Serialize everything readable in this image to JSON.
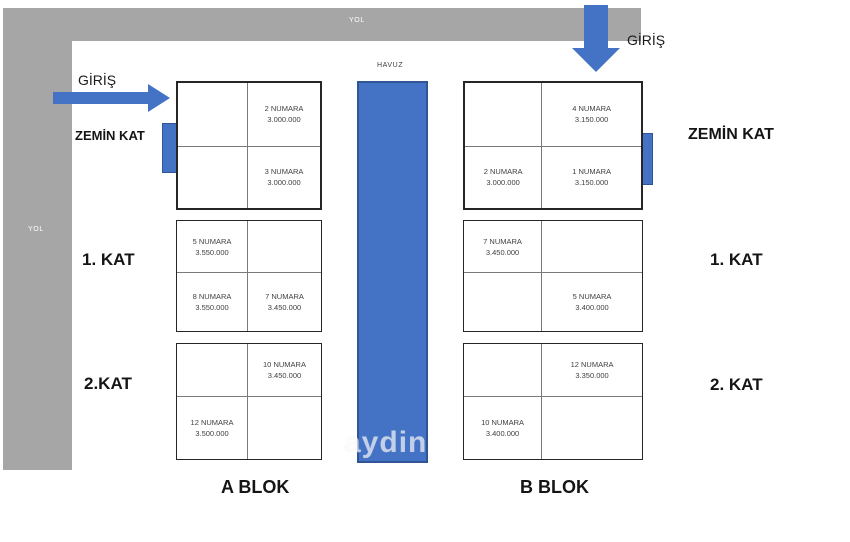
{
  "roads": {
    "top_label": "YOL",
    "left_label": "YOL"
  },
  "pool": {
    "label": "HAVUZ"
  },
  "entrances": {
    "left": "GİRİŞ",
    "right": "GİRİŞ"
  },
  "floor_labels": {
    "left": {
      "ground": "ZEMİN KAT",
      "first": "1. KAT",
      "second": "2.KAT"
    },
    "right": {
      "ground": "ZEMİN KAT",
      "first": "1. KAT",
      "second": "2. KAT"
    }
  },
  "blocks": {
    "a": {
      "name": "A BLOK",
      "floors": [
        {
          "floor": "ZEMİN KAT",
          "cells": [
            {
              "l1": "",
              "l2": ""
            },
            {
              "l1": "2 NUMARA",
              "l2": "3.000.000"
            },
            {
              "l1": "",
              "l2": ""
            },
            {
              "l1": "3 NUMARA",
              "l2": "3.000.000"
            }
          ]
        },
        {
          "floor": "1. KAT",
          "cells": [
            {
              "l1": "5 NUMARA",
              "l2": "3.550.000"
            },
            {
              "l1": "",
              "l2": ""
            },
            {
              "l1": "8 NUMARA",
              "l2": "3.550.000"
            },
            {
              "l1": "7 NUMARA",
              "l2": "3.450.000"
            }
          ]
        },
        {
          "floor": "2. KAT",
          "cells": [
            {
              "l1": "",
              "l2": ""
            },
            {
              "l1": "10 NUMARA",
              "l2": "3.450.000"
            },
            {
              "l1": "12 NUMARA",
              "l2": "3.500.000"
            },
            {
              "l1": "",
              "l2": ""
            }
          ]
        }
      ]
    },
    "b": {
      "name": "B BLOK",
      "floors": [
        {
          "floor": "ZEMİN KAT",
          "cells": [
            {
              "l1": "",
              "l2": ""
            },
            {
              "l1": "4 NUMARA",
              "l2": "3.150.000"
            },
            {
              "l1": "2 NUMARA",
              "l2": "3.000.000"
            },
            {
              "l1": "1 NUMARA",
              "l2": "3.150.000"
            }
          ]
        },
        {
          "floor": "1. KAT",
          "cells": [
            {
              "l1": "7 NUMARA",
              "l2": "3.450.000"
            },
            {
              "l1": "",
              "l2": ""
            },
            {
              "l1": "",
              "l2": ""
            },
            {
              "l1": "5 NUMARA",
              "l2": "3.400.000"
            }
          ]
        },
        {
          "floor": "2. KAT",
          "cells": [
            {
              "l1": "",
              "l2": ""
            },
            {
              "l1": "12 NUMARA",
              "l2": "3.350.000"
            },
            {
              "l1": "10 NUMARA",
              "l2": "3.400.000"
            },
            {
              "l1": "",
              "l2": ""
            }
          ]
        }
      ]
    }
  },
  "watermark": "aydin",
  "colors": {
    "accent_blue": "#4472c4",
    "pool_border": "#2f5597",
    "road_gray": "#a6a6a6",
    "cell_text": "#3f3f3f"
  }
}
